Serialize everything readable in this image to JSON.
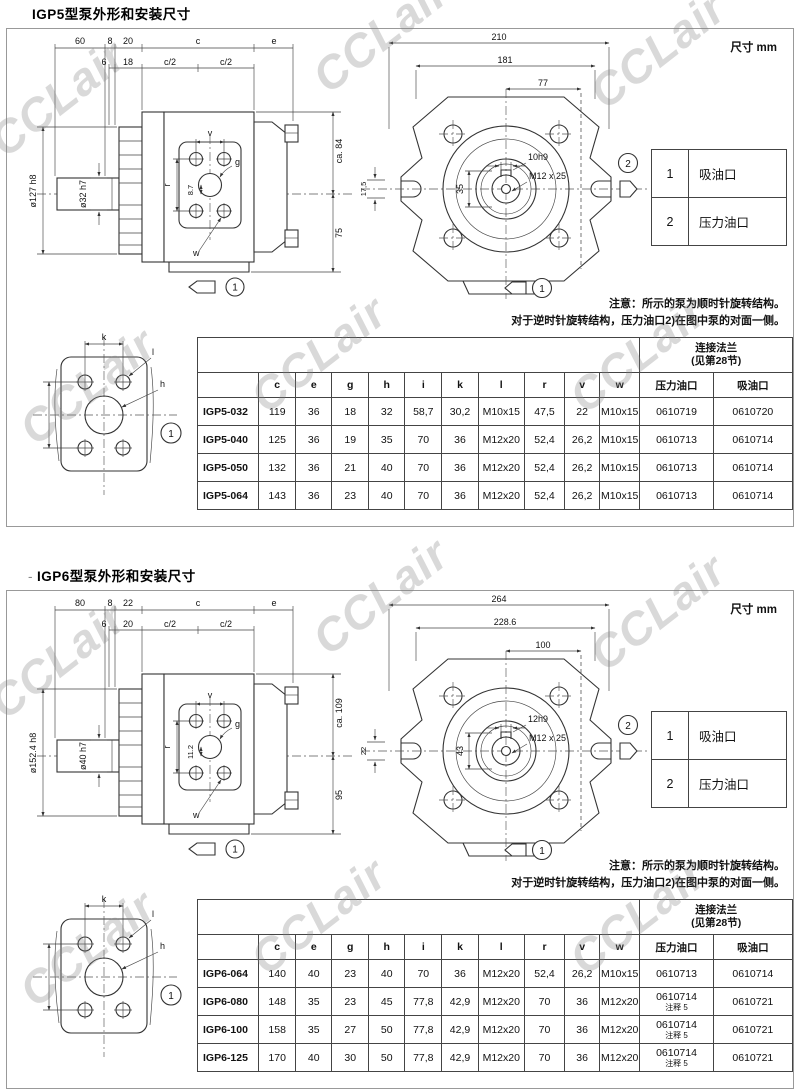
{
  "watermark": {
    "text": "CCLair"
  },
  "sections": [
    {
      "title_prefix": "",
      "title": "IGP5型泵外形和安装尺寸",
      "unit_label": "尺寸 mm",
      "side_view": {
        "dims_row1": [
          "60",
          "8",
          "20",
          "c",
          "e"
        ],
        "dims_row2": [
          "6",
          "18",
          "c/2",
          "c/2"
        ],
        "shaft_outer": "ø127 h8",
        "shaft_inner": "ø32 h7",
        "label_v": "v",
        "label_g": "g",
        "label_r": "r",
        "center_offset": "8.7",
        "label_w": "w",
        "height_top": "ca. 84",
        "height_bottom": "75",
        "view_marker": "1"
      },
      "front_view": {
        "width_overall": "210",
        "width_bolts": "181",
        "width_port": "77",
        "left_dim": "17,5",
        "key_dim": "10h9",
        "thread": "M12 x 25",
        "center_dim": "35",
        "marker_outlet": "2",
        "marker_inlet": "1"
      },
      "flange_view": {
        "label_k": "k",
        "label_l": "l",
        "label_h": "h",
        "marker": "1"
      },
      "legend": [
        {
          "num": "1",
          "label": "吸油口"
        },
        {
          "num": "2",
          "label": "压力油口"
        }
      ],
      "notes": [
        "注意：所示的泵为顺时针旋转结构。",
        "对于逆时针旋转结构，压力油口2)在图中泵的对面一侧。"
      ],
      "table": {
        "flange_header": "连接法兰",
        "flange_subheader": "(见第28节)",
        "columns": [
          "c",
          "e",
          "g",
          "h",
          "i",
          "k",
          "l",
          "r",
          "v",
          "w",
          "压力油口",
          "吸油口"
        ],
        "rows": [
          {
            "model": "IGP5-032",
            "values": [
              "119",
              "36",
              "18",
              "32",
              "58,7",
              "30,2",
              "M10x15",
              "47,5",
              "22",
              "M10x15",
              "0610719",
              "0610720"
            ]
          },
          {
            "model": "IGP5-040",
            "values": [
              "125",
              "36",
              "19",
              "35",
              "70",
              "36",
              "M12x20",
              "52,4",
              "26,2",
              "M10x15",
              "0610713",
              "0610714"
            ]
          },
          {
            "model": "IGP5-050",
            "values": [
              "132",
              "36",
              "21",
              "40",
              "70",
              "36",
              "M12x20",
              "52,4",
              "26,2",
              "M10x15",
              "0610713",
              "0610714"
            ]
          },
          {
            "model": "IGP5-064",
            "values": [
              "143",
              "36",
              "23",
              "40",
              "70",
              "36",
              "M12x20",
              "52,4",
              "26,2",
              "M10x15",
              "0610713",
              "0610714"
            ]
          }
        ]
      }
    },
    {
      "title_prefix": "-",
      "title": "IGP6型泵外形和安装尺寸",
      "unit_label": "尺寸 mm",
      "side_view": {
        "dims_row1": [
          "80",
          "8",
          "22",
          "c",
          "e"
        ],
        "dims_row2": [
          "6",
          "20",
          "c/2",
          "c/2"
        ],
        "shaft_outer": "ø152.4 h8",
        "shaft_inner": "ø40 h7",
        "label_v": "v",
        "label_g": "g",
        "label_r": "r",
        "center_offset": "11.2",
        "label_w": "w",
        "height_top": "ca. 109",
        "height_bottom": "95",
        "view_marker": "1"
      },
      "front_view": {
        "width_overall": "264",
        "width_bolts": "228.6",
        "width_port": "100",
        "left_dim": "22",
        "key_dim": "12h9",
        "thread": "M12 x 25",
        "center_dim": "43",
        "marker_outlet": "2",
        "marker_inlet": "1"
      },
      "flange_view": {
        "label_k": "k",
        "label_l": "l",
        "label_h": "h",
        "marker": "1"
      },
      "legend": [
        {
          "num": "1",
          "label": "吸油口"
        },
        {
          "num": "2",
          "label": "压力油口"
        }
      ],
      "notes": [
        "注意：所示的泵为顺时针旋转结构。",
        "对于逆时针旋转结构，压力油口2)在图中泵的对面一侧。"
      ],
      "table": {
        "flange_header": "连接法兰",
        "flange_subheader": "(见第28节)",
        "columns": [
          "c",
          "e",
          "g",
          "h",
          "i",
          "k",
          "l",
          "r",
          "v",
          "w",
          "压力油口",
          "吸油口"
        ],
        "rows": [
          {
            "model": "IGP6-064",
            "values": [
              "140",
              "40",
              "23",
              "40",
              "70",
              "36",
              "M12x20",
              "52,4",
              "26,2",
              "M10x15",
              "0610713",
              "0610714"
            ]
          },
          {
            "model": "IGP6-080",
            "values": [
              "148",
              "35",
              "23",
              "45",
              "77,8",
              "42,9",
              "M12x20",
              "70",
              "36",
              "M12x20",
              "0610714\n注释 5",
              "0610721"
            ]
          },
          {
            "model": "IGP6-100",
            "values": [
              "158",
              "35",
              "27",
              "50",
              "77,8",
              "42,9",
              "M12x20",
              "70",
              "36",
              "M12x20",
              "0610714\n注释 5",
              "0610721"
            ]
          },
          {
            "model": "IGP6-125",
            "values": [
              "170",
              "40",
              "30",
              "50",
              "77,8",
              "42,9",
              "M12x20",
              "70",
              "36",
              "M12x20",
              "0610714\n注释 5",
              "0610721"
            ]
          }
        ]
      }
    }
  ]
}
